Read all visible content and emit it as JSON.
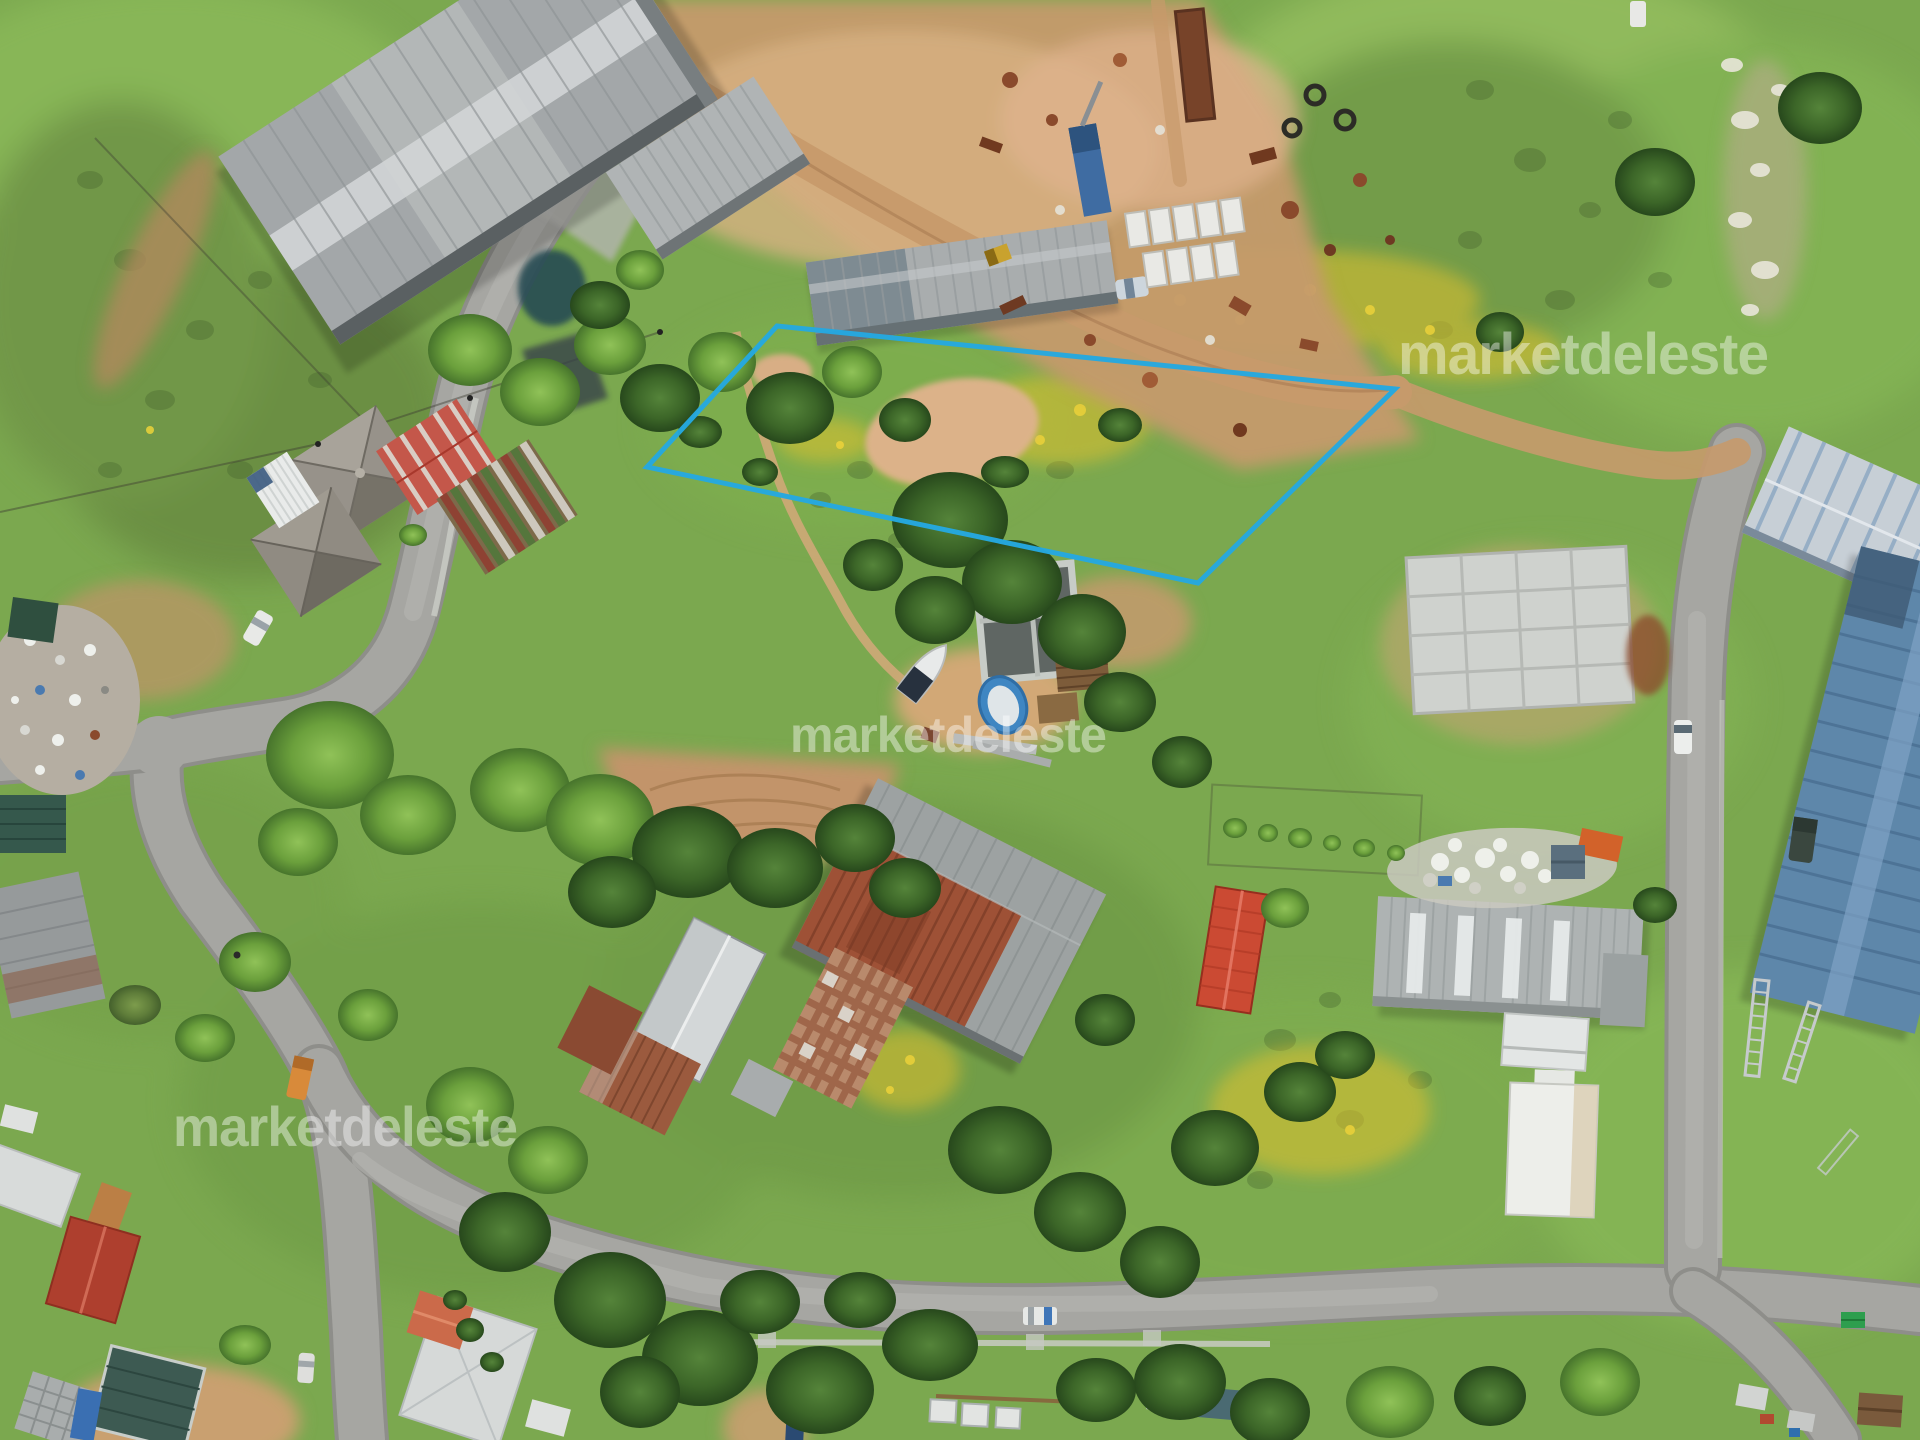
{
  "image": {
    "title": "Aerial drone photograph of a semi-rural neighborhood with an outlined land parcel for sale",
    "width": 1920,
    "height": 1440
  },
  "watermark": {
    "text": "marketdeleste",
    "color": "#ffffff",
    "opacity": 0.42,
    "instances": [
      "top-right",
      "center",
      "bottom-left"
    ]
  },
  "boundary": {
    "label": "property lot outline",
    "color": "#25a8e0",
    "stroke_width": 5,
    "points": "777,326 1395,389 1198,583 647,467"
  },
  "palette": {
    "grass": "#7ba84f",
    "dirt": "#c59a6c",
    "paved_road": "#a6a6a2",
    "rust_roof": "#9e5136",
    "metal_roof": "#a3a7a9",
    "blue_roof": "#5e87aa",
    "red_roof": "#cb4a33",
    "flowers_yellow": "#e0c12e",
    "outline_cyan": "#25a8e0"
  }
}
